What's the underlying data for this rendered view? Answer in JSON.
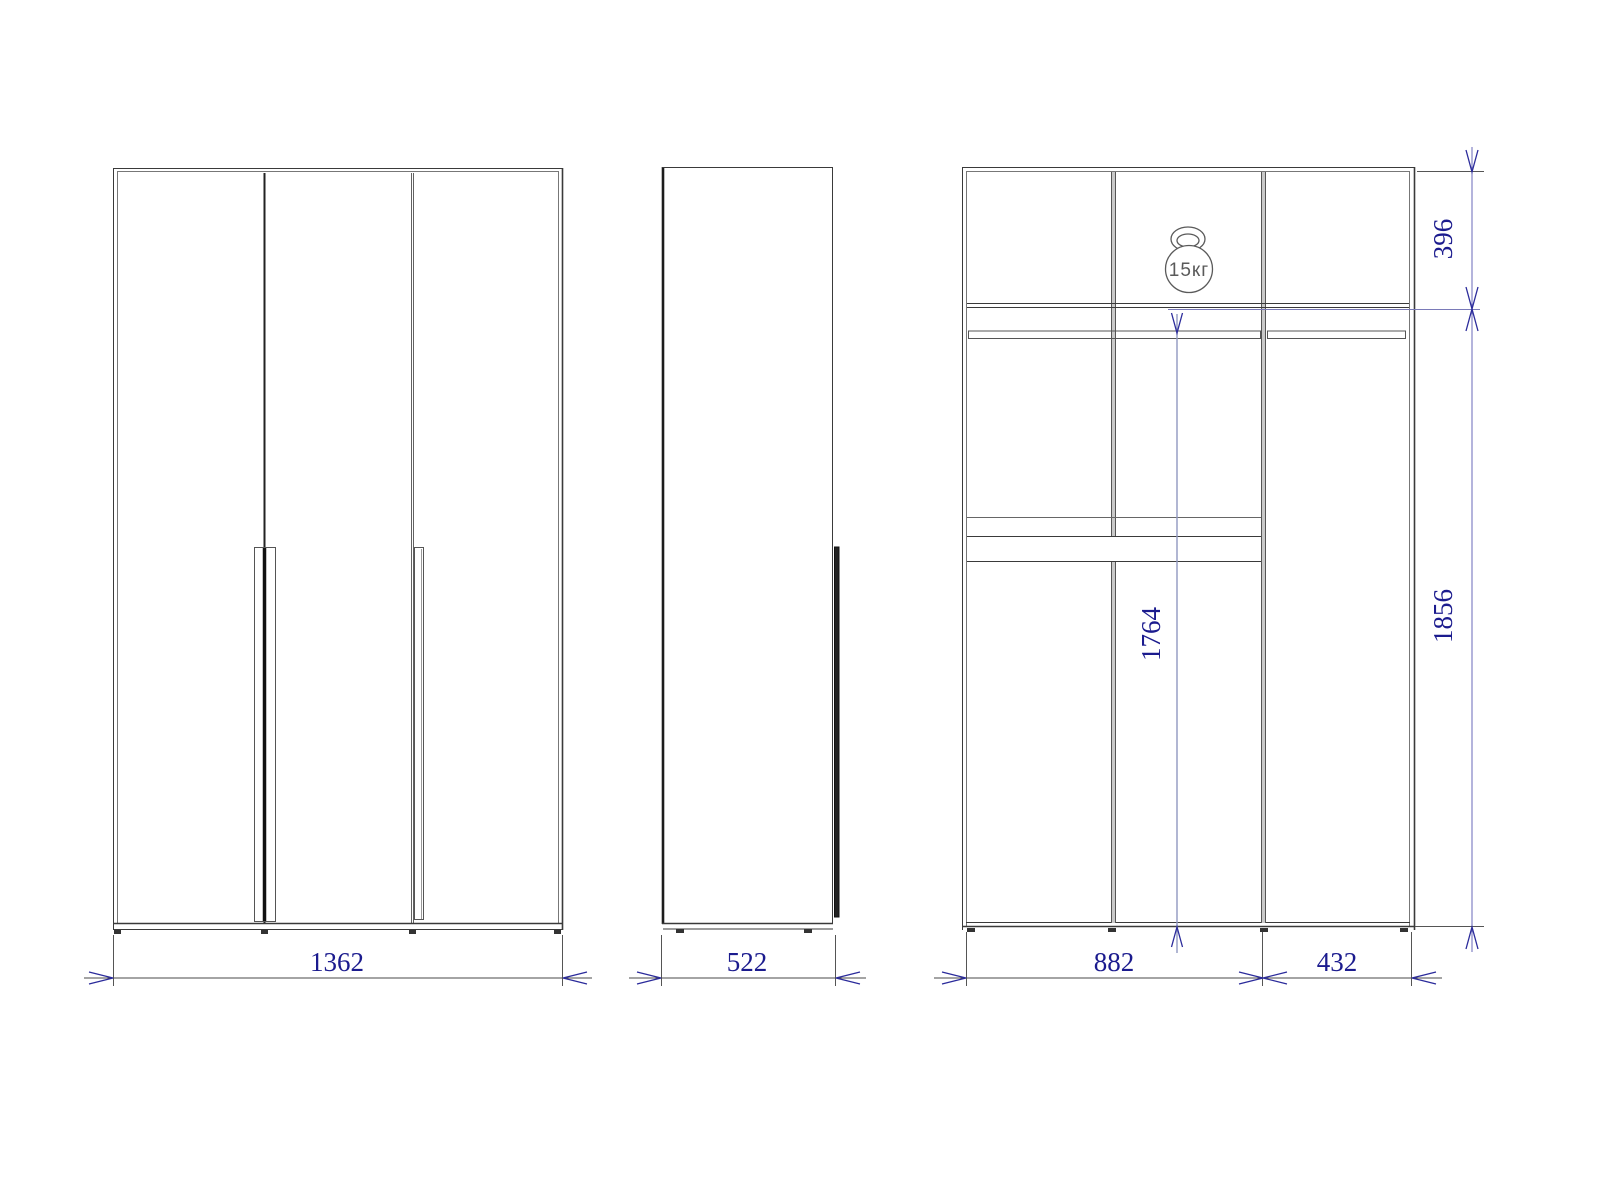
{
  "colors": {
    "background": "#ffffff",
    "structure_line": "#3a3a3a",
    "partition_fill": "#c9c9c9",
    "dimension_text": "#1b1b8e",
    "dimension_arrow": "#2b2b9b",
    "dimension_line_blue": "#6868b8",
    "hanging_dim_line": "#9098c0",
    "load_icon_stroke": "#5a5a5a"
  },
  "icons": {
    "load": "kettlebell-icon"
  },
  "views": {
    "front": {
      "width": "1362"
    },
    "side": {
      "depth": "522"
    },
    "internal": {
      "top_section_height": "396",
      "interior_height": "1856",
      "hanging_height": "1764",
      "left_section_width": "882",
      "right_section_width": "432",
      "max_load": "15кг"
    }
  }
}
